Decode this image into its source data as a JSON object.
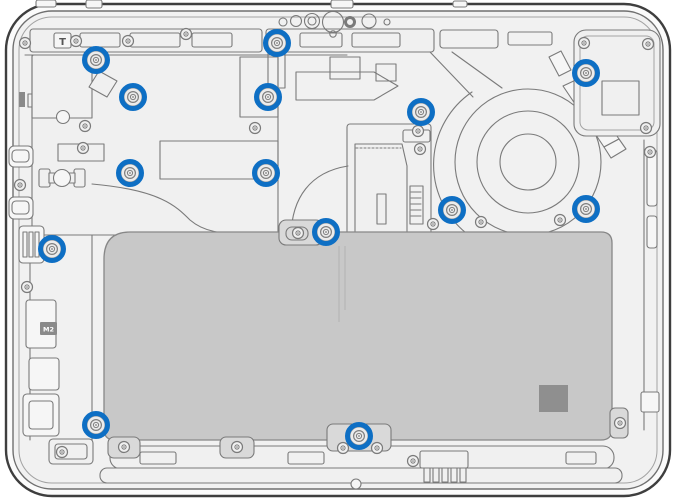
{
  "diagram": {
    "kind": "laptop-bottom-case-internal-view",
    "description": "Technical line-art diagram of a laptop interior (bottom view) with screw locations highlighted by blue circles: motherboard at left, cooling fan and heat pipe at right, large battery at bottom center.",
    "canvas": {
      "width": 676,
      "height": 500
    },
    "colors": {
      "background": "#ffffff",
      "shell_fill": "#fbfbfb",
      "panel_fill": "#f1f1f1",
      "line": "#7a7a7a",
      "outline": "#3e3e3e",
      "battery_fill": "#c8c8c8",
      "battery_pad_fill": "#8f8f8f",
      "marker_blue": "#0e6fc4"
    },
    "labels": {
      "t_label": "T",
      "m2_label": "M2"
    },
    "screw_markers": {
      "count": 14,
      "style": {
        "ring_color": "#0e6fc4",
        "outer_radius": 14,
        "ring_width": 5
      },
      "positions": [
        {
          "id": 1,
          "x": 96,
          "y": 60
        },
        {
          "id": 2,
          "x": 277,
          "y": 43
        },
        {
          "id": 3,
          "x": 133,
          "y": 97
        },
        {
          "id": 4,
          "x": 268,
          "y": 97
        },
        {
          "id": 5,
          "x": 421,
          "y": 112
        },
        {
          "id": 6,
          "x": 586,
          "y": 73
        },
        {
          "id": 7,
          "x": 130,
          "y": 173
        },
        {
          "id": 8,
          "x": 266,
          "y": 173
        },
        {
          "id": 9,
          "x": 452,
          "y": 210
        },
        {
          "id": 10,
          "x": 586,
          "y": 209
        },
        {
          "id": 11,
          "x": 52,
          "y": 249
        },
        {
          "id": 12,
          "x": 326,
          "y": 232
        },
        {
          "id": 13,
          "x": 96,
          "y": 425
        },
        {
          "id": 14,
          "x": 359,
          "y": 436
        }
      ]
    }
  }
}
